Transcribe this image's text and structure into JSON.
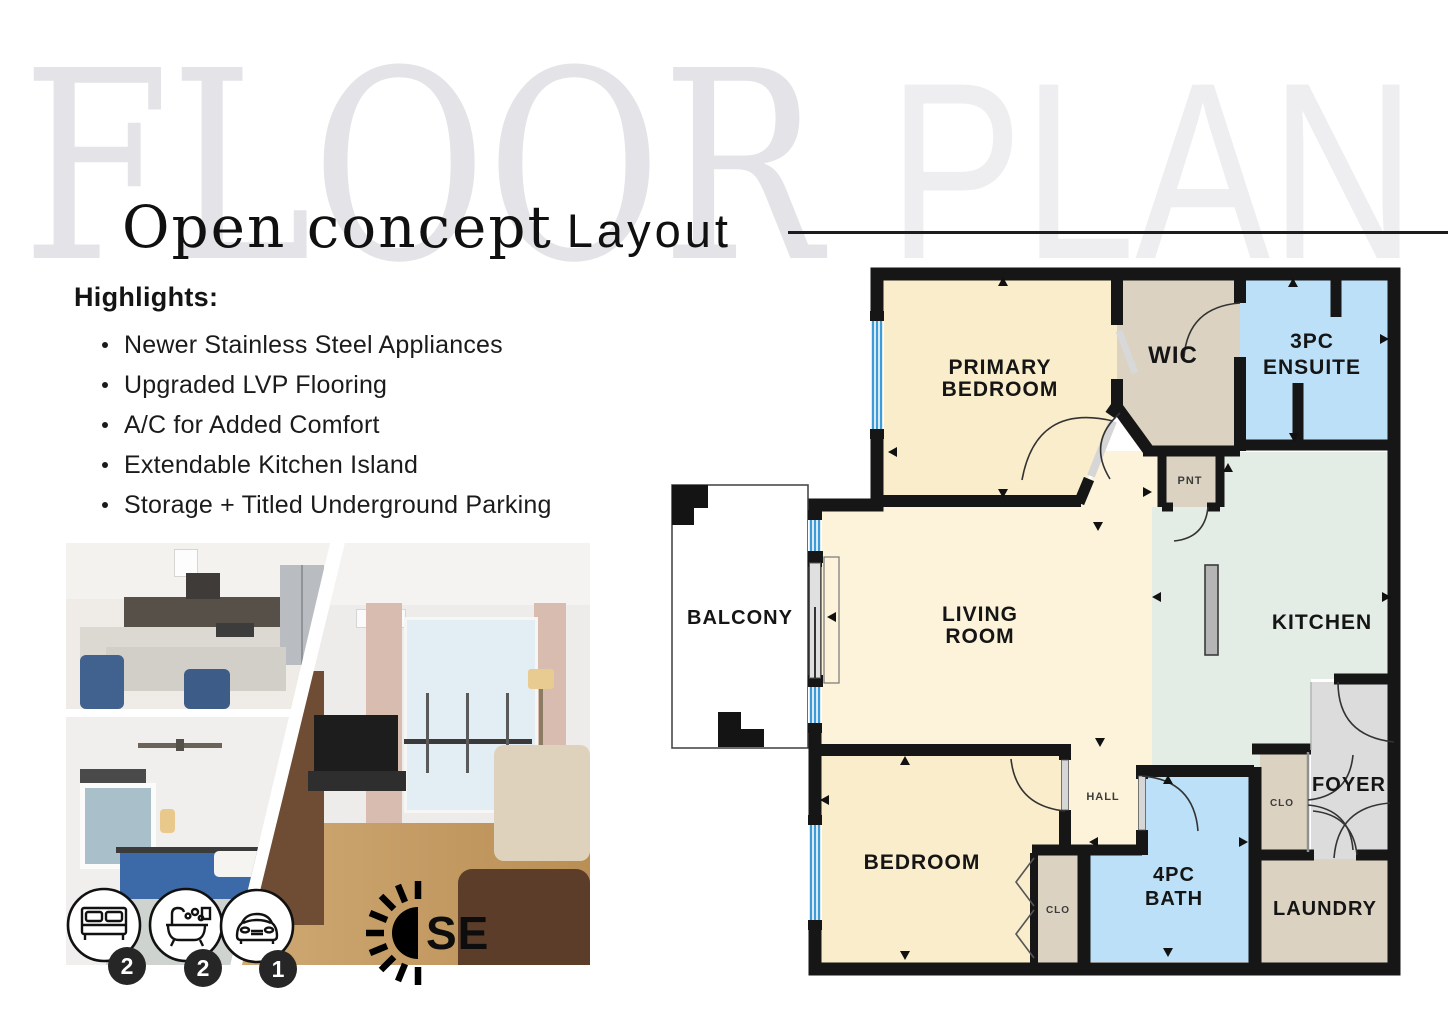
{
  "watermark": {
    "floor": "FLOOR",
    "plan": "PLAN"
  },
  "title": {
    "main": "Open concept",
    "accent": "Layout"
  },
  "highlights": {
    "heading": "Highlights:",
    "items": [
      "Newer Stainless Steel Appliances",
      "Upgraded LVP Flooring",
      "A/C for Added Comfort",
      "Extendable Kitchen Island",
      "Storage + Titled Underground Parking"
    ]
  },
  "stats": {
    "bedrooms": "2",
    "bathrooms": "2",
    "parking": "1",
    "orientation": "SE"
  },
  "floorplan": {
    "rooms": {
      "primary_line1": "PRIMARY",
      "primary_line2": "BEDROOM",
      "wic": "WIC",
      "ensuite_line1": "3PC",
      "ensuite_line2": "ENSUITE",
      "pantry": "PNT",
      "balcony": "BALCONY",
      "living_line1": "LIVING",
      "living_line2": "ROOM",
      "kitchen": "KITCHEN",
      "hall": "HALL",
      "bedroom": "BEDROOM",
      "bedroom_closet": "CLO",
      "bath_line1": "4PC",
      "bath_line2": "BATH",
      "foyer_closet": "CLO",
      "foyer": "FOYER",
      "laundry": "LAUNDRY"
    },
    "colors": {
      "bedroom_fill": "#FAEDCB",
      "living_fill": "#FCF3DA",
      "closet_fill": "#DBD2C1",
      "bath_fill": "#BCE0F7",
      "kitchen_fill": "#E4EDE5",
      "foyer_fill": "#DCDCDC",
      "wall": "#161616",
      "window": "#3E9BD6"
    }
  }
}
